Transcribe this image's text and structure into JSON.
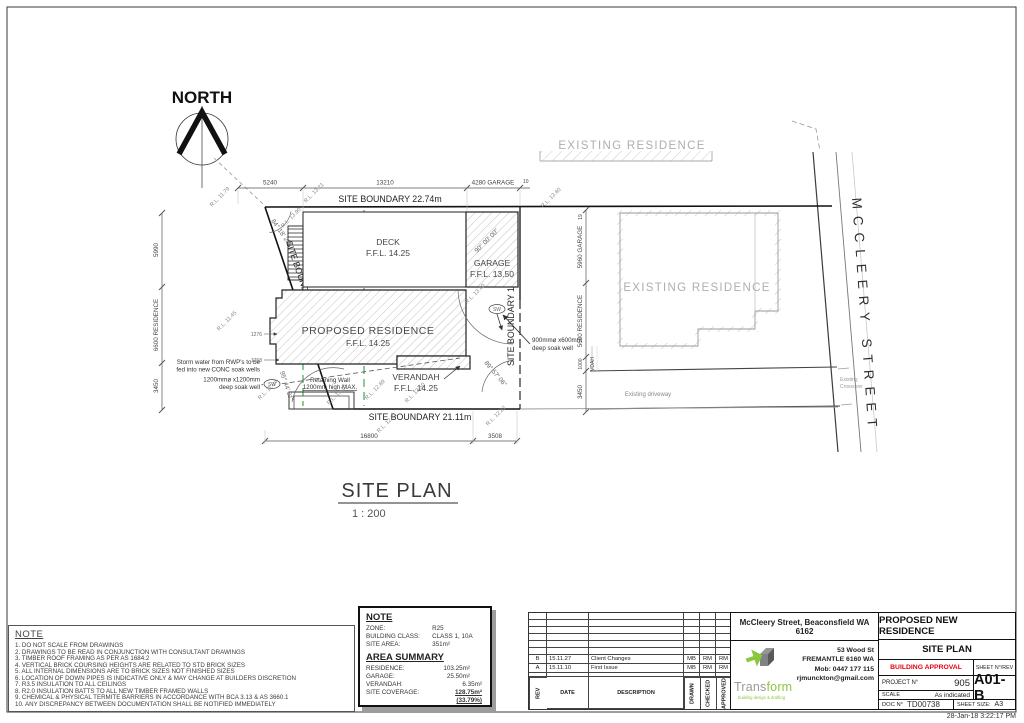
{
  "colors": {
    "accent_green": "#8CC63F",
    "logo_gray": "#808285",
    "approval_red": "#E8000D",
    "hatch_gray": "#c2c2c2",
    "sewer_green": "#2F9E44"
  },
  "drawing": {
    "north": "NORTH",
    "plan_title": "SITE PLAN",
    "plan_scale": "1 : 200",
    "street": "MCCLEERY STREET",
    "ghost_top": "EXISTING RESIDENCE",
    "ghost_right": "EXISTING RESIDENCE",
    "driveway": "Existing driveway",
    "crossover_1": "Existing",
    "crossover_2": "Crossover",
    "boundary_top": "SITE BOUNDARY 22.74m",
    "boundary_left": "SITE BOUNDARY 16.09m",
    "boundary_right": "SITE BOUNDARY 16.03m",
    "boundary_bottom": "SITE BOUNDARY 21.11m",
    "deck": "DECK",
    "deck_ffl": "F.F.L. 14.25",
    "garage": "GARAGE",
    "garage_ffl": "F.F.L. 13.50",
    "residence": "PROPOSED RESIDENCE",
    "residence_ffl": "F.F.L. 14.25",
    "verandah": "VERANDAH",
    "verandah_ffl": "F.F.L. 14.25",
    "angle_nw": "84° 18' 23\"",
    "angle_garage": "90° 00' 00\"",
    "angle_sw": "95° 44' 31\"",
    "angle_se": "89° 57' 06\"",
    "dim_top": [
      "5240",
      "13210",
      "4280 GARAGE",
      "10"
    ],
    "dim_left": [
      "5990",
      "6600 RESIDENCE",
      "3450"
    ],
    "dim_right": [
      "19",
      "5960 GARAGE",
      "5600 RESIDENCE",
      "1000",
      "VDAH",
      "3450"
    ],
    "dim_bottom": [
      "16800",
      "3508"
    ],
    "dim_notch": [
      "1276",
      "1768"
    ],
    "rl": {
      "a": "R.L. 11.79",
      "b": "R.L. 13.21",
      "c": "R.L. 13.90",
      "d": "R.L. 13.60",
      "e": "R.L. 11.45",
      "f": "R.L. 11.84",
      "g": "R.L. 13.40",
      "h": "R.L. 13.10",
      "i": "R.L. 12.69",
      "j": "R.L. 13.50",
      "k": "R.L. 12.71",
      "l": "R.L. 12.82"
    },
    "sw": "SW",
    "storm_1": "Storm water from RWP's to be",
    "storm_2": "fed into new CONC soak wells",
    "soak1200_1": "1200mmø x1200mm",
    "soak1200_2": "deep soak well",
    "soak900_1": "900mmø x600mm",
    "soak900_2": "deep soak well",
    "retain_1": "Retaining Wall",
    "retain_2": "1200mm high MAX."
  },
  "notes": {
    "title": "NOTE",
    "items": [
      "1. DO NOT SCALE FROM DRAWINGS",
      "2. DRAWINGS TO BE READ IN CONJUNCTION WITH CONSULTANT DRAWINGS",
      "3. TIMBER ROOF FRAMING AS PER AS 1684.2",
      "4. VERTICAL BRICK COURSING HEIGHTS ARE RELATED TO STD BRICK SIZES",
      "5. ALL INTERNAL DIMENSIONS ARE TO BRICK SIZES NOT FINISHED SIZES",
      "6. LOCATION OF DOWN PIPES IS INDICATIVE ONLY & MAY CHANGE AT BUILDERS DISCRETION",
      "7. R3.5 INSULATION TO ALL CEILINGS",
      "8. R2.0 INSULATION BATTS TO ALL NEW TIMBER FRAMED WALLS",
      "9. CHEMICAL & PHYSICAL TERMITE BARRIERS IN ACCORDANCE WITH BCA 3.13 & AS 3660.1",
      "10. ANY DISCREPANCY BETWEEN DOCUMENTATION SHALL BE NOTIFIED IMMEDIATELY"
    ]
  },
  "summary": {
    "note_title": "NOTE",
    "zone_label": "ZONE:",
    "zone": "R25",
    "class_label": "BUILDING CLASS:",
    "class": "CLASS 1, 10A",
    "site_area_label": "SITE AREA:",
    "site_area": "351m²",
    "area_title": "AREA SUMMARY",
    "res_label": "RESIDENCE:",
    "res": "103.25m²",
    "gar_label": "GARAGE:",
    "gar": "25.50m²",
    "ver_label": "VERANDAH:",
    "ver": "6.35m²",
    "cov_label": "SITE COVERAGE:",
    "cov": "128.75m² (33.79%)"
  },
  "revisions": {
    "col_rev": "REV",
    "col_date": "DATE",
    "col_desc": "DESCRIPTION",
    "col_drawn": "DRAWN",
    "col_checked": "CHECKED",
    "col_approved": "APPROVED",
    "rows": [
      {
        "rev": "B",
        "date": "15.11.27",
        "desc": "Client Changes",
        "drawn": "MB",
        "checked": "RM",
        "approved": "RM"
      },
      {
        "rev": "A",
        "date": "15.11.10",
        "desc": "First Issue",
        "drawn": "MB",
        "checked": "RM",
        "approved": "RM"
      }
    ]
  },
  "titleblock": {
    "address_title": "McCleery Street, Beaconsfield WA 6162",
    "addr_1": "53 Wood St",
    "addr_2": "FREMANTLE 6160 WA",
    "addr_3": "Mob: 0447 177 115",
    "addr_4": "rjmunckton@gmail.com",
    "logo_a": "Trans",
    "logo_b": "form",
    "logo_tag": "building design & drafting",
    "project_title": "PROPOSED NEW RESIDENCE",
    "sheet_title": "SITE PLAN",
    "approval": "BUILDING APPROVAL",
    "sheetno_label": "SHEET N°/REV",
    "project_label": "PROJECT N°",
    "project_no": "905",
    "sheet_no": "A01-B",
    "scale_label": "SCALE",
    "scale_value": "As indicated",
    "doc_label": "DOC N°",
    "doc_no": "TD00738",
    "size_label": "SHEET SIZE:",
    "size_value": "A3",
    "timestamp": "28-Jan-18 3:22:17 PM"
  }
}
